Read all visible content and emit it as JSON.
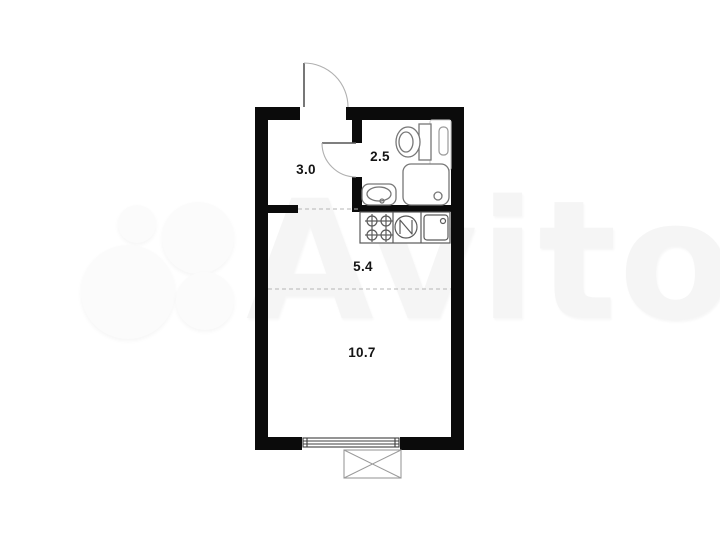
{
  "watermark": {
    "text": "Avito",
    "color": "#f5f5f5"
  },
  "plan": {
    "type": "studio-apartment-floor-plan",
    "rooms": [
      {
        "name": "hallway",
        "area": "3.0"
      },
      {
        "name": "bathroom",
        "area": "2.5"
      },
      {
        "name": "kitchen-zone",
        "area": "5.4"
      },
      {
        "name": "living-zone",
        "area": "10.7"
      }
    ],
    "fixtures": [
      "entrance-door",
      "bathroom-door",
      "toilet",
      "shower-cabin",
      "wash-basin",
      "towel-rail-cabinet",
      "stove-4-burners",
      "round-appliance",
      "kitchen-sink",
      "window",
      "balcony-box"
    ],
    "colors": {
      "wall": "#0b0b0b",
      "fixture_stroke": "#777777",
      "dashed_divider": "#b5b5b5",
      "background": "#ffffff"
    }
  }
}
